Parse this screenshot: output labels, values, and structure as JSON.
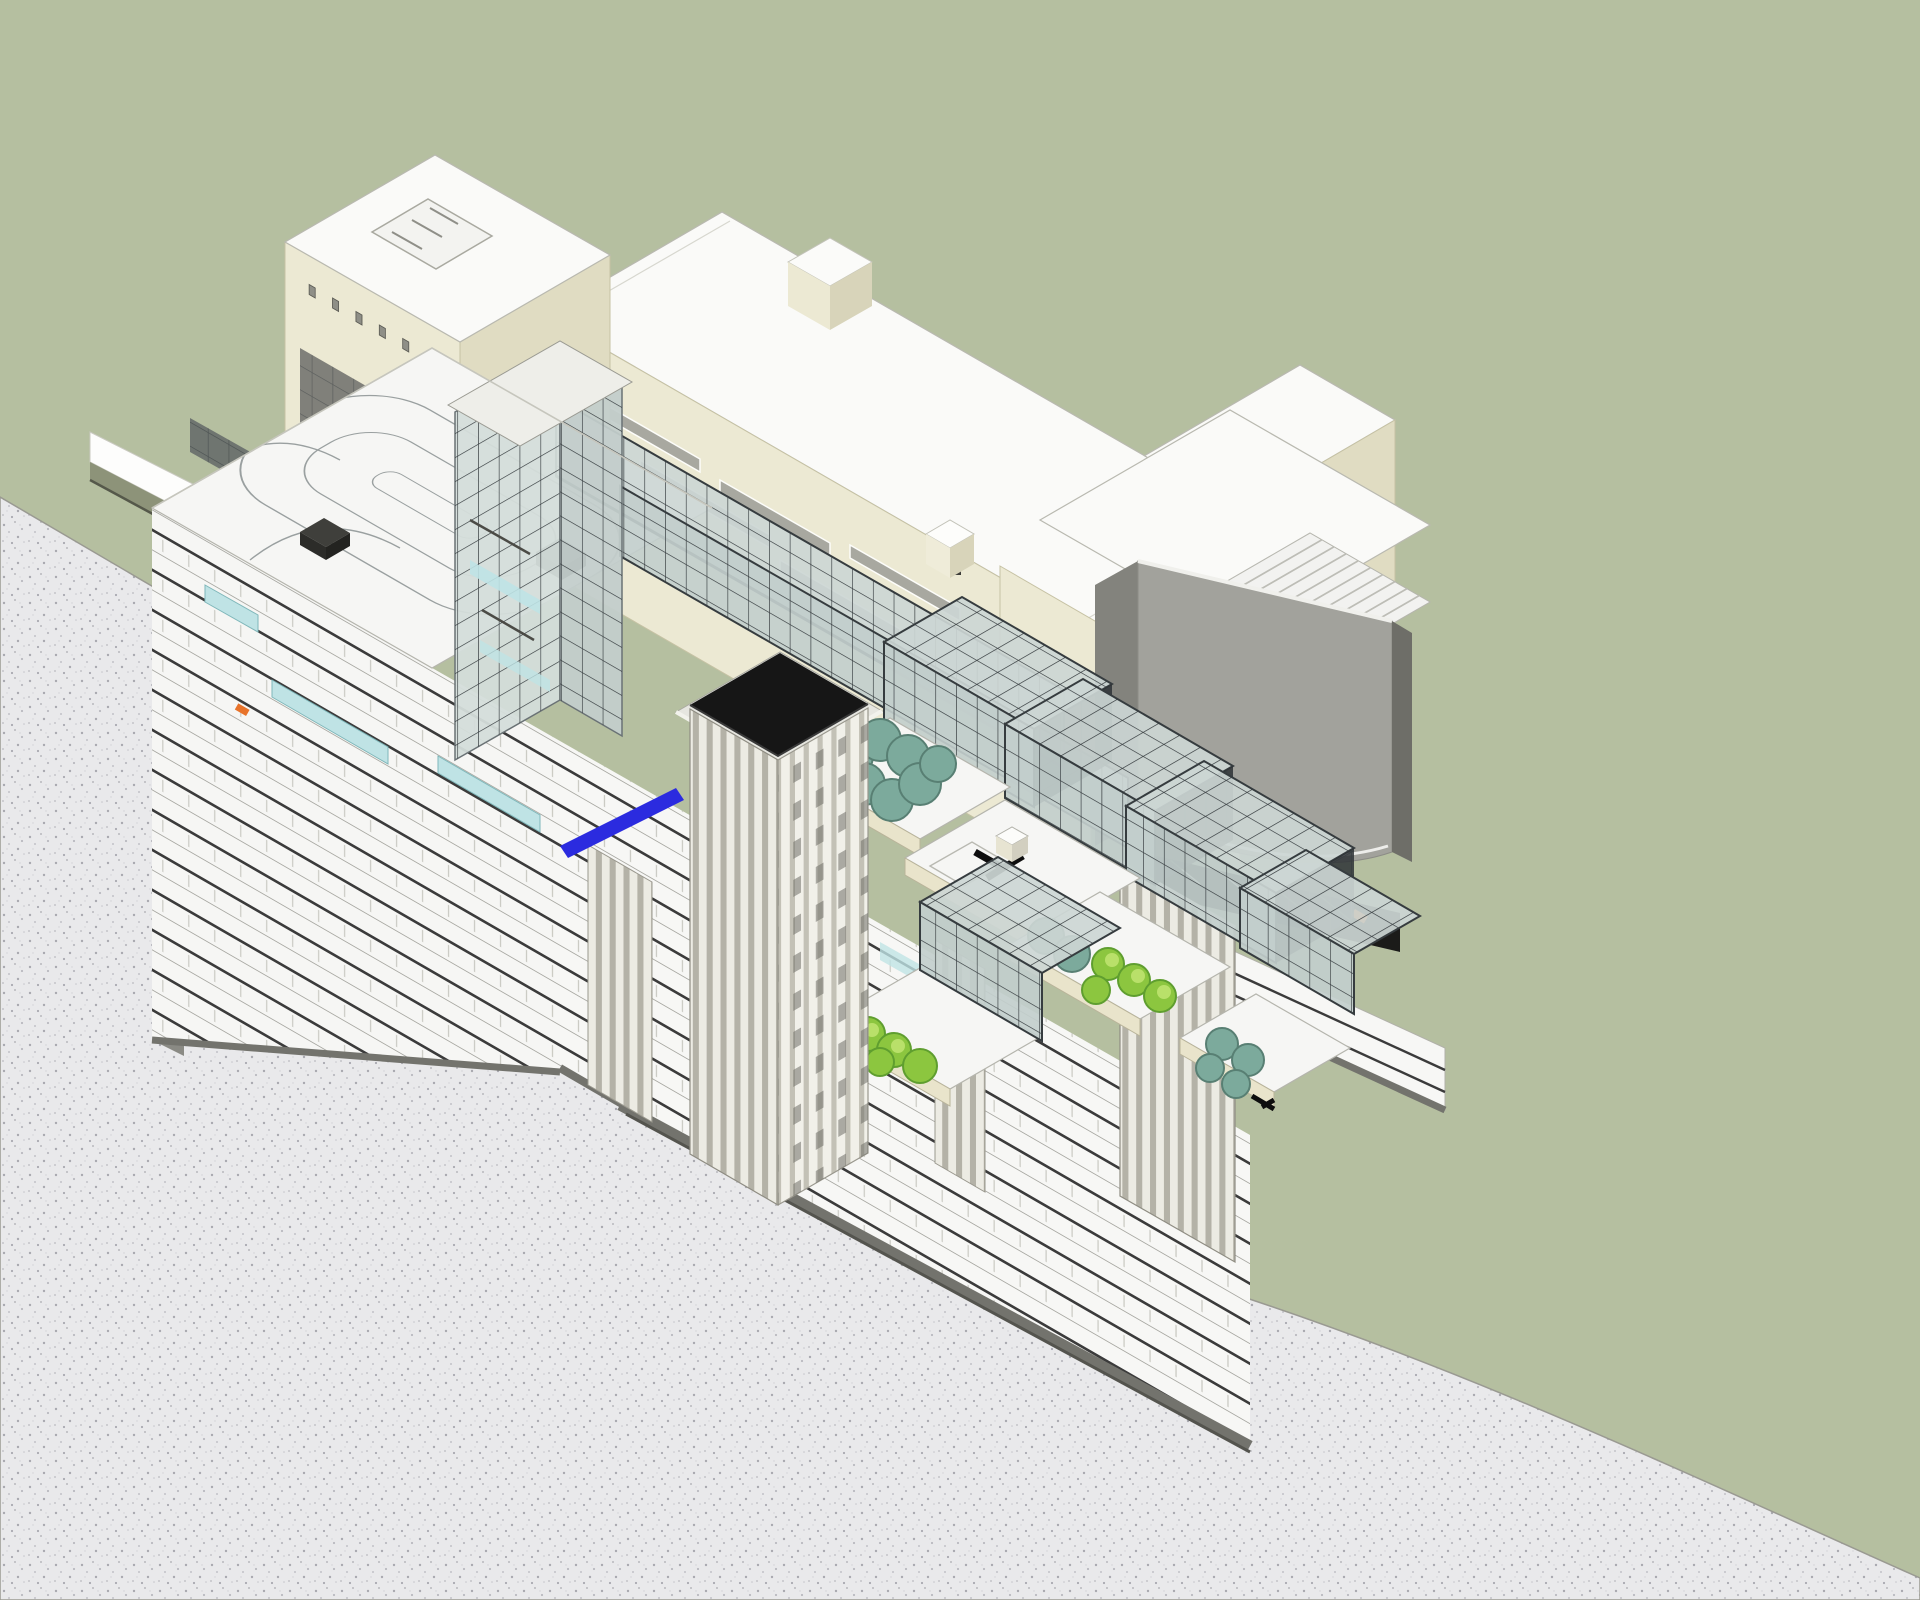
{
  "meta": {
    "domain": "architectural-3d-view",
    "view_type": "sectional axonometric (cutaway BIM model rendering)",
    "visible_text": "none"
  },
  "theme": {
    "bg-green": "#b5bfa0",
    "earth": "#e9e9eb",
    "earth-dot": "#a9a9b0",
    "cream": "#ece9d3",
    "cream-shade": "#e0dcc2",
    "cream-dark": "#c6c2a4",
    "cream-fascia": "#e9e4cb",
    "roof-white": "#fafaf8",
    "lattice": "#363c3f",
    "glass": "#ccd6d4",
    "glass-teal": "#bfe3e5",
    "slab-dark": "#3b3b3b",
    "cut-gray": "#73736d",
    "gray-mass": "#a2a29c",
    "gray-mass-dark": "#83837d",
    "black-roof": "#161616",
    "stripe-light": "#ecebe3",
    "stripe-dark": "#b4b2a7",
    "tree-teal": "#7caa9c",
    "tree-green": "#8cc63f",
    "accent-blue": "#2b2bdf",
    "accent-orange": "#e8732a"
  },
  "scene": {
    "background": {
      "backdrop_color_name": "sage-green",
      "cut_plane_texture": "stippled light gray (sectioned earth)"
    },
    "upper_massing": {
      "material": "cream stucco, flat white roofs",
      "blocks": 4,
      "features": [
        "courtyard block with grid of small square windows",
        "large wall opening showing interior",
        "horizontal slot windows",
        "rooftop penthouse box",
        "open-roof hall with ridged auditorium floor and parapet posts"
      ]
    },
    "gray_volume": {
      "description": "dark gray sloped-face box at right end",
      "count": 1
    },
    "atrium": {
      "space_frame_canopy_bands": 2,
      "lattice_tower": 1,
      "stepped_lattice_boxes": 5
    },
    "terraces": {
      "count": 5,
      "helipad_marking_color": "black",
      "fascia_color_name": "cream"
    },
    "trees": {
      "teal_round_trees": 13,
      "bright_green_trees": 8
    },
    "section": {
      "left_wing_floor_plates": 9,
      "lower_section_floor_lines": 13,
      "cut_edge_color_name": "gray band",
      "striped_pilaster_towers": 4,
      "black_roof_tower": 1
    },
    "accents": {
      "blue_ramp_strips": 1,
      "blue_dashes": 2,
      "orange_markers": 4,
      "cyan_glass_railings": 3
    },
    "roof_deck": {
      "markings": "oval lane / track curves",
      "vent_boxes": 2
    }
  }
}
